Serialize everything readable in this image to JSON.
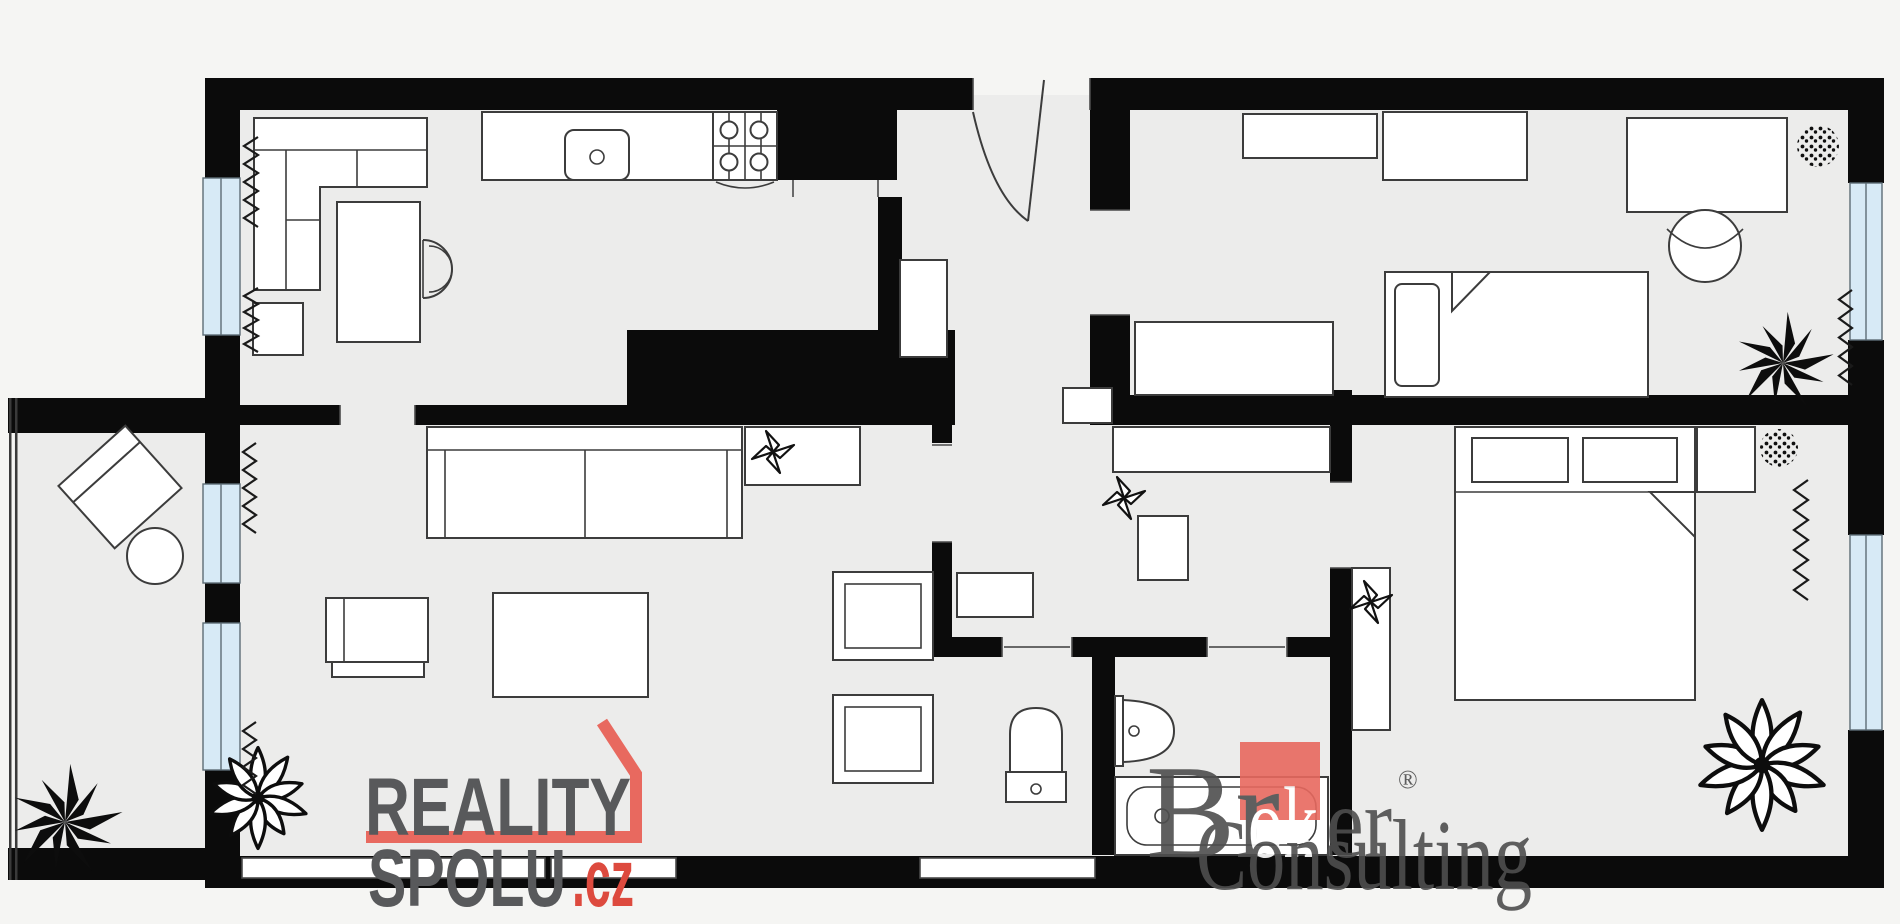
{
  "scene": {
    "type": "apartment-floor-plan",
    "style": "black-walls monochrome plan with light blue windows and watermark logos"
  },
  "branding": {
    "reality_spolu": {
      "line1": "REALITY",
      "line2": "SPOLU",
      "tld": ".cz"
    },
    "broker_consulting": {
      "part1": "Br",
      "part2": "ok",
      "part3": "er",
      "line2": "Consulting",
      "registered_mark": "®"
    }
  },
  "colors": {
    "bg": "#f5f5f3",
    "floor": "#ececeb",
    "wall": "#0b0b0b",
    "furniture": "#ffffff",
    "outline": "#3c3c3c",
    "window": "#d7eaf6",
    "accent-red": "#e8695f",
    "accent-red-dark": "#dd4a3e",
    "logo-gray": "#58595b",
    "broker-gray": "#4e4e4e",
    "broker-red": "#e8695f"
  },
  "rooms": [
    {
      "name": "kitchen-dining",
      "furniture": [
        "corner-sofa",
        "dining-table",
        "chair",
        "kitchen-counter",
        "sink",
        "stove-4-burner",
        "low-cabinet"
      ]
    },
    {
      "name": "living-room",
      "furniture": [
        "sofa",
        "sideboard",
        "fan-symbol",
        "armchair",
        "armchair",
        "coffee-table",
        "side-chair",
        "plant"
      ]
    },
    {
      "name": "balcony",
      "furniture": [
        "lounge-chair",
        "round-table",
        "plant"
      ]
    },
    {
      "name": "hallway",
      "furniture": [
        "entrance-door",
        "closet",
        "shoe-cabinet",
        "corridor-cabinet",
        "wardrobe",
        "washing-machine",
        "fan-symbol"
      ]
    },
    {
      "name": "wc",
      "furniture": [
        "toilet"
      ]
    },
    {
      "name": "bathroom",
      "furniture": [
        "wash-basin",
        "bathtub"
      ]
    },
    {
      "name": "bedroom-1",
      "furniture": [
        "wall-shelf",
        "wardrobe",
        "single-bed",
        "long-cabinet",
        "desk",
        "desk-chair",
        "plant-round",
        "plant-spiky",
        "radiator",
        "window"
      ]
    },
    {
      "name": "bedroom-2",
      "furniture": [
        "double-bed",
        "pillows",
        "nightstand",
        "wardrobe",
        "fan-symbol",
        "plant-round",
        "plant-leafy",
        "radiator",
        "window"
      ]
    }
  ],
  "symbols": {
    "radiator-icon": "zigzag line along window walls",
    "window-icon": "light blue double-line strip in wall",
    "plant-dotted-icon": "dotted disc",
    "plant-spiky-icon": "black spiky rosette",
    "plant-leafy-icon": "outlined petal rosette",
    "fan-icon": "four-blade pinwheel star",
    "door-icon": "quarter-circle swing arc"
  }
}
